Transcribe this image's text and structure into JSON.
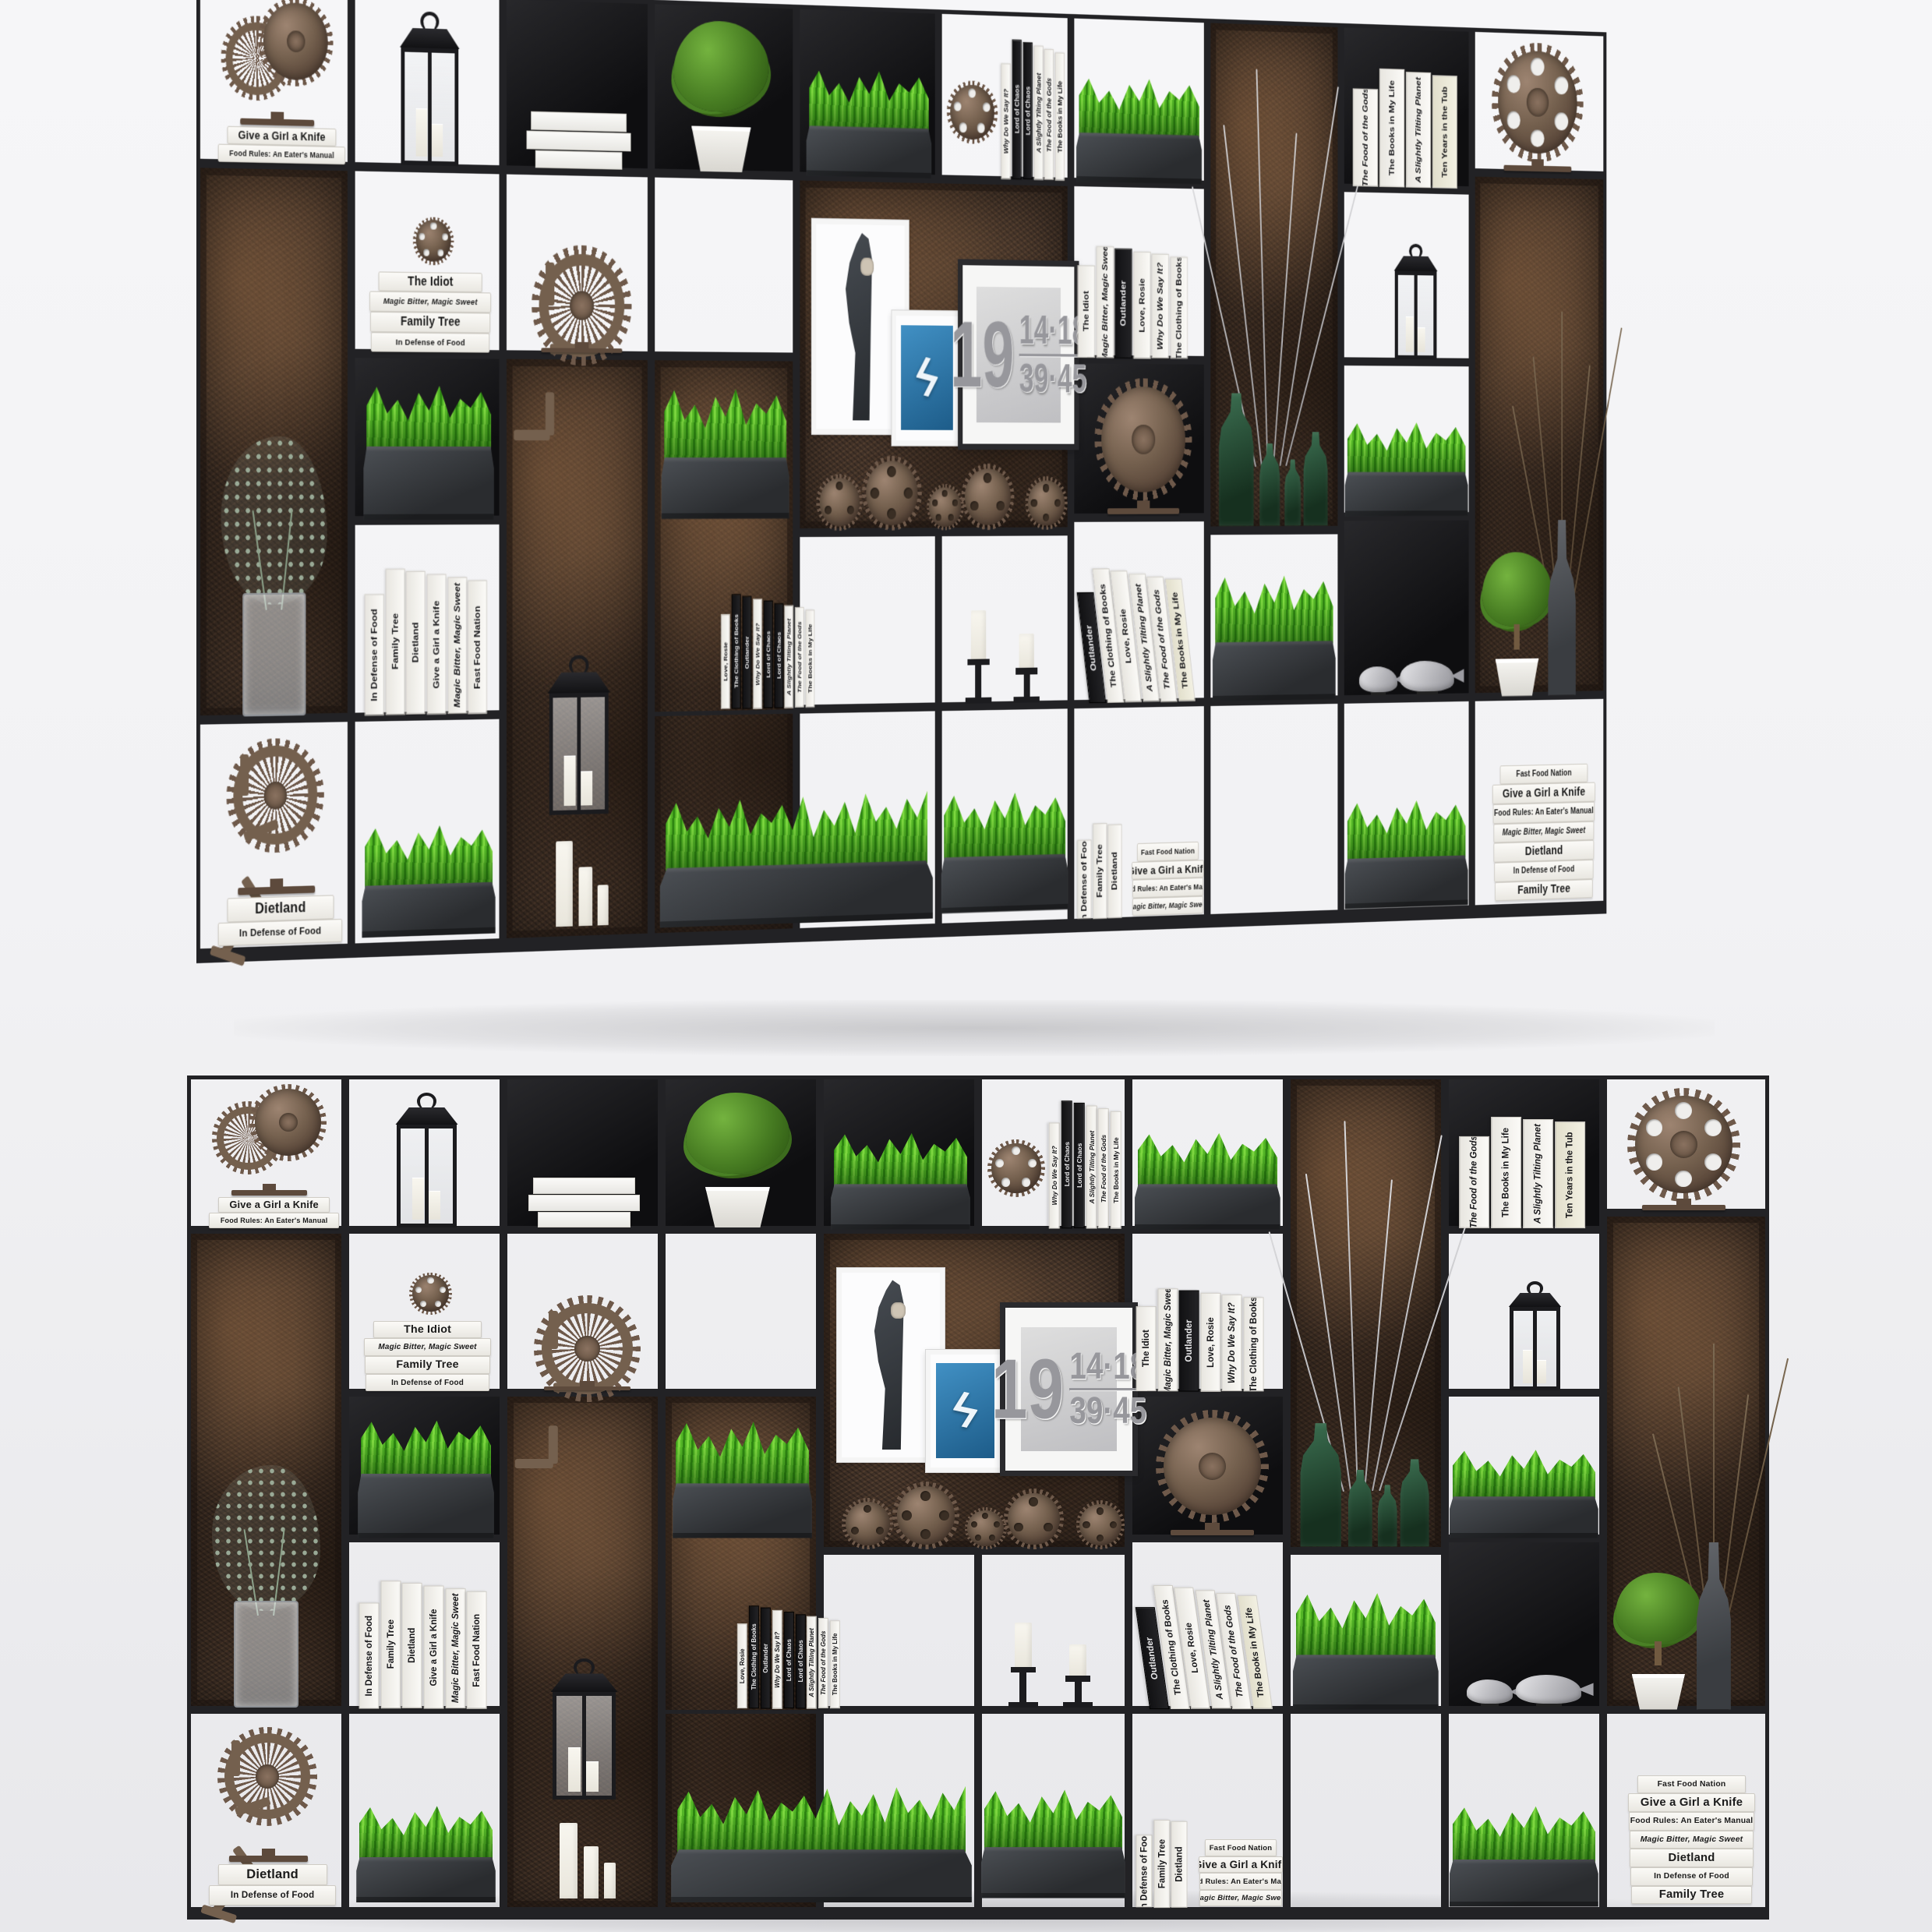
{
  "scene": {
    "description": "Industrial metal shelving unit 3D render shown in two views",
    "views": [
      {
        "label": "perspective-view"
      },
      {
        "label": "front-view"
      }
    ]
  },
  "colors": {
    "background": "#f2f2f4",
    "frame": "#222225",
    "rust_mid": "#46352a",
    "black_cell": "#141416",
    "planter_light": "#4b4f54",
    "planter_dark": "#2a2c2f",
    "grass_light": "#7cd63f",
    "grass_mid": "#53b526",
    "grass_dark": "#2e8512",
    "book_white": "#f7f6f2",
    "book_dark": "#1b1b1e",
    "frame_blue": "#1d5c89",
    "gear_brown": "#74604e",
    "gear_teeth": "#6e594a",
    "candle": "#f8f6ef",
    "bottle_green": "#16301f",
    "metal_fish": "#94949a"
  },
  "shelf": {
    "cells": [
      {
        "x": 0,
        "y": 1.5,
        "w": 10,
        "h": 18,
        "bg": "w"
      },
      {
        "x": 10,
        "y": 1.5,
        "w": 10,
        "h": 18,
        "bg": "w"
      },
      {
        "x": 20,
        "y": 1.5,
        "w": 10,
        "h": 18,
        "bg": "b"
      },
      {
        "x": 30,
        "y": 1.5,
        "w": 10,
        "h": 18,
        "bg": "b"
      },
      {
        "x": 40,
        "y": 1.5,
        "w": 10,
        "h": 18,
        "bg": "b"
      },
      {
        "x": 50,
        "y": 1.5,
        "w": 9.5,
        "h": 18,
        "bg": "w"
      },
      {
        "x": 59.5,
        "y": 1.5,
        "w": 10,
        "h": 18,
        "bg": "w"
      },
      {
        "x": 69.5,
        "y": 1.5,
        "w": 10,
        "h": 55.5,
        "bg": "r"
      },
      {
        "x": 79.5,
        "y": 1.5,
        "w": 10,
        "h": 18,
        "bg": "b"
      },
      {
        "x": 89.5,
        "y": 1.5,
        "w": 10.5,
        "h": 16,
        "bg": "w"
      },
      {
        "x": 0,
        "y": 19.5,
        "w": 10,
        "h": 56,
        "bg": "r"
      },
      {
        "x": 10,
        "y": 19.5,
        "w": 10,
        "h": 19,
        "bg": "w"
      },
      {
        "x": 10,
        "y": 38.5,
        "w": 10,
        "h": 17,
        "bg": "b"
      },
      {
        "x": 10,
        "y": 55.5,
        "w": 10,
        "h": 20,
        "bg": "w"
      },
      {
        "x": 20,
        "y": 19.5,
        "w": 10,
        "h": 19,
        "bg": "w"
      },
      {
        "x": 20,
        "y": 38.5,
        "w": 10,
        "h": 60.5,
        "bg": "r"
      },
      {
        "x": 30,
        "y": 19.5,
        "w": 10,
        "h": 19,
        "bg": "w"
      },
      {
        "x": 30,
        "y": 38.5,
        "w": 10,
        "h": 60.5,
        "bg": "r"
      },
      {
        "x": 40,
        "y": 19.5,
        "w": 19.5,
        "h": 37.5,
        "bg": "r"
      },
      {
        "x": 40,
        "y": 57,
        "w": 10,
        "h": 18.5,
        "bg": "w"
      },
      {
        "x": 50,
        "y": 57,
        "w": 9.5,
        "h": 18.5,
        "bg": "w"
      },
      {
        "x": 59.5,
        "y": 19.5,
        "w": 10,
        "h": 19,
        "bg": "w"
      },
      {
        "x": 59.5,
        "y": 38.5,
        "w": 10,
        "h": 17,
        "bg": "b"
      },
      {
        "x": 59.5,
        "y": 55.5,
        "w": 10,
        "h": 20,
        "bg": "w"
      },
      {
        "x": 69.5,
        "y": 57,
        "w": 10,
        "h": 18.5,
        "bg": "w"
      },
      {
        "x": 79.5,
        "y": 19.5,
        "w": 10,
        "h": 19,
        "bg": "w"
      },
      {
        "x": 79.5,
        "y": 38.5,
        "w": 10,
        "h": 17,
        "bg": "w"
      },
      {
        "x": 79.5,
        "y": 55.5,
        "w": 10,
        "h": 20,
        "bg": "b"
      },
      {
        "x": 89.5,
        "y": 17.5,
        "w": 10.5,
        "h": 58,
        "bg": "r"
      },
      {
        "x": 0,
        "y": 75.5,
        "w": 10,
        "h": 23.5,
        "bg": "w"
      },
      {
        "x": 10,
        "y": 75.5,
        "w": 10,
        "h": 23.5,
        "bg": "w"
      },
      {
        "x": 30,
        "y": 75.5,
        "w": 10,
        "h": 23.5,
        "bg": "w"
      },
      {
        "x": 40,
        "y": 75.5,
        "w": 10,
        "h": 23.5,
        "bg": "w"
      },
      {
        "x": 50,
        "y": 75.5,
        "w": 9.5,
        "h": 23.5,
        "bg": "w"
      },
      {
        "x": 59.5,
        "y": 75.5,
        "w": 10,
        "h": 23.5,
        "bg": "w"
      },
      {
        "x": 69.5,
        "y": 75.5,
        "w": 10,
        "h": 23.5,
        "bg": "w"
      },
      {
        "x": 79.5,
        "y": 75.5,
        "w": 10,
        "h": 23.5,
        "bg": "w"
      },
      {
        "x": 89.5,
        "y": 75.5,
        "w": 10.5,
        "h": 23.5,
        "bg": "w"
      }
    ],
    "items": [
      {
        "type": "grass",
        "name": "grass-planter",
        "x": 10.8,
        "y": 41,
        "w": 8.6,
        "h": 14.5,
        "bladeH": 50
      },
      {
        "type": "grass",
        "name": "grass-planter",
        "x": 10.7,
        "y": 86,
        "w": 8.8,
        "h": 12
      },
      {
        "type": "grass",
        "name": "grass-planter",
        "x": 30.7,
        "y": 41,
        "w": 8.8,
        "h": 14.5
      },
      {
        "type": "grass",
        "name": "grass-planter-long",
        "x": 30.6,
        "y": 84,
        "w": 19,
        "h": 14
      },
      {
        "type": "grass",
        "name": "grass-planter",
        "x": 40.7,
        "y": 7.5,
        "w": 8.8,
        "h": 12
      },
      {
        "type": "grass",
        "name": "grass-planter",
        "x": 50.2,
        "y": 84,
        "w": 9.1,
        "h": 13.5
      },
      {
        "type": "grass",
        "name": "grass-planter",
        "x": 59.9,
        "y": 7.5,
        "w": 9.2,
        "h": 12
      },
      {
        "type": "grass",
        "name": "grass-planter",
        "x": 69.9,
        "y": 61,
        "w": 9.2,
        "h": 14.5
      },
      {
        "type": "grass",
        "name": "grass-planter",
        "x": 79.8,
        "y": 44.5,
        "w": 9.4,
        "h": 11
      },
      {
        "type": "grass",
        "name": "grass-planter",
        "x": 79.8,
        "y": 86,
        "w": 9.4,
        "h": 12.5
      },
      {
        "type": "vase-euc",
        "name": "eucalyptus-vase",
        "x": 1.6,
        "y": 47,
        "w": 6.8,
        "h": 28.3
      },
      {
        "type": "lantern",
        "name": "lantern",
        "x": 22.7,
        "y": 69.5,
        "w": 4.8,
        "h": 16.5
      },
      {
        "type": "candles",
        "v": "plain",
        "name": "candles",
        "x": 23.4,
        "y": 88,
        "w": 4.2,
        "h": 9.5
      },
      {
        "type": "branches",
        "name": "silver-branches",
        "x": 70.6,
        "y": 5,
        "w": 7.6,
        "h": 45
      },
      {
        "type": "bottles",
        "name": "green-glass-bottles",
        "x": 70.2,
        "y": 41.5,
        "w": 8.6,
        "h": 15
      },
      {
        "type": "twigs",
        "name": "twig-vase",
        "x": 94.2,
        "y": 31,
        "w": 4.6,
        "h": 44.5
      },
      {
        "type": "plantpot",
        "topiary": 1,
        "name": "topiary-plant",
        "x": 90.2,
        "y": 59.5,
        "w": 5.6,
        "h": 16
      },
      {
        "type": "bottle-gray",
        "name": "gray-bottle",
        "x": 95,
        "y": 56,
        "w": 3,
        "h": 19.5
      },
      {
        "type": "fish",
        "name": "fish-figurines",
        "x": 80.9,
        "y": 69.8,
        "w": 7.4,
        "h": 5.5
      },
      {
        "type": "plantpot",
        "name": "boxwood-plant",
        "x": 31.4,
        "y": 3.5,
        "w": 6.8,
        "h": 15.8
      },
      {
        "type": "booklying",
        "name": "stacked-papers",
        "x": 21.6,
        "y": 13,
        "w": 7,
        "h": 6.3
      },
      {
        "type": "lantern",
        "name": "lantern",
        "x": 12.9,
        "y": 3.5,
        "w": 4.5,
        "h": 15.8
      },
      {
        "type": "lantern",
        "name": "lantern",
        "x": 83.3,
        "y": 25.5,
        "w": 3.8,
        "h": 12.8
      },
      {
        "type": "candles",
        "v": "sticks",
        "name": "candlesticks",
        "x": 51.8,
        "y": 62.5,
        "w": 6.4,
        "h": 12.8
      },
      {
        "type": "frame",
        "v": "hand",
        "name": "picture-frame-hand",
        "x": 41.1,
        "y": 24,
        "w": 6.2,
        "h": 21.5
      },
      {
        "type": "frame",
        "v": "bolt",
        "name": "picture-frame-lightning",
        "x": 46.7,
        "y": 33.5,
        "w": 4.4,
        "h": 13.2,
        "glyph": "ϟ"
      },
      {
        "type": "frame",
        "v": "numbers",
        "name": "picture-frame-numbers",
        "x": 51.4,
        "y": 28,
        "w": 8,
        "h": 19,
        "lines": [
          "19",
          "14·18",
          "39·45"
        ]
      },
      {
        "type": "gearsrow",
        "name": "gears-collection",
        "x": 41.4,
        "y": 50.5,
        "w": 17.6,
        "h": 6.3
      },
      {
        "type": "gear",
        "v": "double",
        "name": "gear-sculpture-double",
        "x": 1.7,
        "y": 2.5,
        "w": 7,
        "h": 13
      },
      {
        "type": "gear",
        "v": "wheel",
        "name": "gear-sculpture-wheel",
        "x": 1.5,
        "y": 77.5,
        "w": 7.3,
        "h": 15.8
      },
      {
        "type": "gear",
        "v": "mini",
        "name": "gear-small",
        "x": 14,
        "y": 24.5,
        "w": 2.8,
        "h": 5.2
      },
      {
        "type": "gear",
        "v": "spinner",
        "name": "gear-sculpture-spinner",
        "x": 21.3,
        "y": 27,
        "w": 8,
        "h": 11.3
      },
      {
        "type": "gear",
        "v": "holes-sm",
        "name": "gear-small",
        "x": 50.5,
        "y": 9,
        "w": 3.8,
        "h": 10.3
      },
      {
        "type": "gear",
        "v": "big",
        "name": "gear-sculpture-large",
        "x": 60.9,
        "y": 40.5,
        "w": 7.8,
        "h": 14.7,
        "hole": "#121214"
      },
      {
        "type": "gear",
        "v": "holes",
        "name": "gear-sculpture-holes",
        "x": 90.7,
        "y": 3,
        "w": 7.8,
        "h": 14.3
      },
      {
        "type": "bookstack",
        "name": "book-stack",
        "x": 1.3,
        "y": 15.5,
        "w": 8.4,
        "h": 3.9,
        "books": [
          {
            "t": "Give a Girl a Knife",
            "s": "big"
          },
          {
            "t": "Food Rules: An Eater's Manual",
            "s": ""
          }
        ]
      },
      {
        "type": "bookstack",
        "name": "book-stack",
        "x": 1.3,
        "y": 93.4,
        "w": 8.2,
        "h": 5,
        "books": [
          {
            "t": "Dietland",
            "s": "big"
          },
          {
            "t": "In Defense of Food",
            "s": ""
          }
        ]
      },
      {
        "type": "bookstack",
        "name": "book-stack",
        "x": 11.1,
        "y": 29.8,
        "w": 8.2,
        "h": 8.6,
        "books": [
          {
            "t": "The Idiot",
            "s": "big"
          },
          {
            "t": "Magic Bitter, Magic Sweet",
            "s": "italic"
          },
          {
            "t": "Family Tree",
            "s": "big"
          },
          {
            "t": "In Defense of Food",
            "s": ""
          }
        ]
      },
      {
        "type": "bookrow",
        "name": "book-row",
        "x": 10.9,
        "y": 60,
        "w": 8.3,
        "h": 15.4,
        "books": [
          {
            "t": "In Defense of Food",
            "s": ""
          },
          {
            "t": "Family Tree",
            "s": "big"
          },
          {
            "t": "Dietland",
            "s": "big"
          },
          {
            "t": "Give a Girl a Knife",
            "s": ""
          },
          {
            "t": "Magic Bitter, Magic Sweet",
            "s": "italic"
          },
          {
            "t": "Fast Food Nation",
            "s": ""
          }
        ]
      },
      {
        "type": "bookrow",
        "name": "book-row",
        "x": 34.8,
        "y": 63,
        "w": 6.8,
        "h": 12.4,
        "books": [
          {
            "t": "Love, Rosie",
            "s": "big"
          },
          {
            "t": "The Clothing of Books",
            "s": "dark"
          },
          {
            "t": "Outlander",
            "s": "dark"
          },
          {
            "t": "Why Do We Say It?",
            "s": "italic"
          },
          {
            "t": "Lord of Chaos",
            "s": "dark"
          },
          {
            "t": "Lord of Chaos",
            "s": "dark"
          },
          {
            "t": "A Slightly Tilting Planet",
            "s": "italic"
          },
          {
            "t": "The Food of the Gods",
            "s": "italic"
          },
          {
            "t": "The Books in My Life",
            "s": ""
          }
        ]
      },
      {
        "type": "bookrow",
        "name": "book-row",
        "x": 54.5,
        "y": 4,
        "w": 4.8,
        "h": 15.4,
        "books": [
          {
            "t": "Why Do We Say It?",
            "s": "italic"
          },
          {
            "t": "Lord of Chaos",
            "s": "dark"
          },
          {
            "t": "Lord of Chaos",
            "s": "dark"
          },
          {
            "t": "A Slightly Tilting Planet",
            "s": "italic"
          },
          {
            "t": "The Food of the Gods",
            "s": "italic"
          },
          {
            "t": "The Books in My Life",
            "s": ""
          }
        ]
      },
      {
        "type": "bookrow",
        "name": "book-row",
        "x": 60,
        "y": 26,
        "w": 8.3,
        "h": 12.4,
        "books": [
          {
            "t": "The Idiot",
            "s": "big"
          },
          {
            "t": "Magic Bitter, Magic Sweet",
            "s": "italic"
          },
          {
            "t": "Outlander",
            "s": "dark"
          },
          {
            "t": "Love, Rosie",
            "s": "big"
          },
          {
            "t": "Why Do We Say It?",
            "s": "italic"
          },
          {
            "t": "The Clothing of Books",
            "s": ""
          }
        ]
      },
      {
        "type": "bookrow",
        "lean": 1,
        "name": "book-row-leaning",
        "x": 60.3,
        "y": 60.5,
        "w": 8,
        "h": 14.9,
        "books": [
          {
            "t": "Outlander",
            "s": "dark"
          },
          {
            "t": "The Clothing of Books",
            "s": ""
          },
          {
            "t": "Love, Rosie",
            "s": "big"
          },
          {
            "t": "A Slightly Tilting Planet",
            "s": "italic"
          },
          {
            "t": "The Food of the Gods",
            "s": "italic"
          },
          {
            "t": "The Books in My Life",
            "s": "cream"
          }
        ]
      },
      {
        "type": "bookrow",
        "name": "book-row",
        "x": 60,
        "y": 88,
        "w": 3.4,
        "h": 10.6,
        "books": [
          {
            "t": "In Defense of Food",
            "s": ""
          },
          {
            "t": "Family Tree",
            "s": "big"
          },
          {
            "t": "Dietland",
            "s": "big"
          }
        ]
      },
      {
        "type": "bookstack",
        "name": "book-stack",
        "x": 63.9,
        "y": 90.3,
        "w": 5.4,
        "h": 8.2,
        "books": [
          {
            "t": "Fast Food Nation",
            "s": ""
          },
          {
            "t": "Give a Girl a Knife",
            "s": "big"
          },
          {
            "t": "Food Rules: An Eater's Manual",
            "s": ""
          },
          {
            "t": "Magic Bitter, Magic Sweet",
            "s": "italic"
          }
        ]
      },
      {
        "type": "bookrow",
        "name": "book-row",
        "x": 80.4,
        "y": 6,
        "w": 8.2,
        "h": 13.4,
        "books": [
          {
            "t": "The Food of the Gods",
            "s": "italic"
          },
          {
            "t": "The Books in My Life",
            "s": ""
          },
          {
            "t": "A Slightly Tilting Planet",
            "s": "italic"
          },
          {
            "t": "Ten Years in the Tub",
            "s": "cream"
          }
        ]
      },
      {
        "type": "bookstack",
        "name": "book-stack",
        "x": 91,
        "y": 82.5,
        "w": 8.2,
        "h": 15.7,
        "books": [
          {
            "t": "Fast Food Nation",
            "s": ""
          },
          {
            "t": "Give a Girl a Knife",
            "s": "big"
          },
          {
            "t": "Food Rules: An Eater's Manual",
            "s": ""
          },
          {
            "t": "Magic Bitter, Magic Sweet",
            "s": "italic"
          },
          {
            "t": "Dietland",
            "s": "big"
          },
          {
            "t": "In Defense of Food",
            "s": ""
          },
          {
            "t": "Family Tree",
            "s": "big"
          }
        ]
      }
    ]
  }
}
